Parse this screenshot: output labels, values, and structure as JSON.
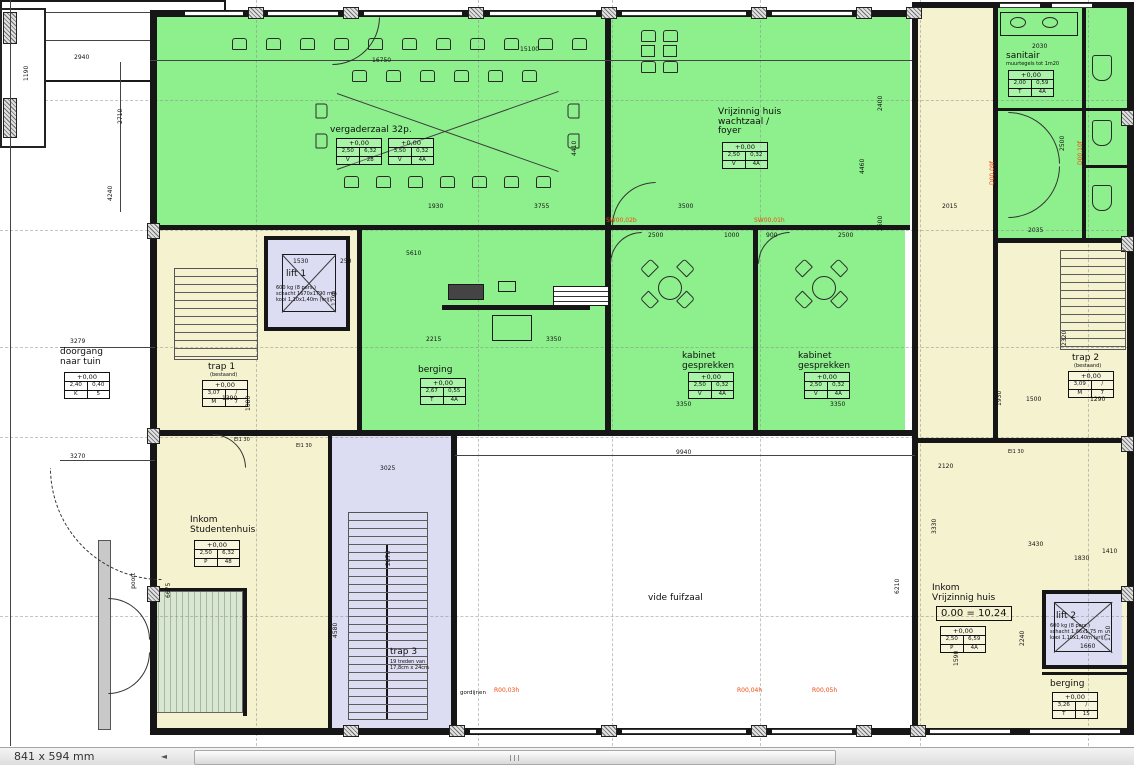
{
  "statusbar": {
    "size": "841 x 594 mm",
    "arrow": "◄"
  },
  "rooms": {
    "vergaderzaal": {
      "l": "vergaderzaal 32p.",
      "tA": {
        "h": "+0,00",
        "a": "2,50",
        "b": "6,32",
        "c": "V",
        "d": "28"
      },
      "tB": {
        "h": "+0,00",
        "a": "3,50",
        "b": "0,32",
        "c": "V",
        "d": "4A"
      }
    },
    "foyer": {
      "l": "Vrijzinnig huis\nwachtzaal /\nfoyer",
      "t": {
        "h": "+0,00",
        "a": "2,50",
        "b": "0,32",
        "c": "V",
        "d": "4A"
      }
    },
    "sanitair": {
      "l": "sanitair",
      "s": "muurtegels tot 1m20",
      "t": {
        "h": "+0,00",
        "a": "2,00",
        "b": "0,59",
        "c": "T",
        "d": "4A"
      }
    },
    "kabinet1": {
      "l": "kabinet\ngesprekken",
      "t": {
        "h": "+0,00",
        "a": "2,50",
        "b": "0,32",
        "c": "V",
        "d": "4A"
      }
    },
    "kabinet2": {
      "l": "kabinet\ngesprekken",
      "t": {
        "h": "+0,00",
        "a": "2,50",
        "b": "0,32",
        "c": "V",
        "d": "4A"
      }
    },
    "berging": {
      "l": "berging",
      "t": {
        "h": "+0,00",
        "a": "2,67",
        "b": "0,55",
        "c": "T",
        "d": "4A"
      }
    },
    "trap1": {
      "l": "trap 1",
      "s": "(bestaand)",
      "t": {
        "h": "+0,00",
        "a": "3,07",
        "b": "/",
        "c": "M",
        "d": "7"
      }
    },
    "trap2": {
      "l": "trap 2",
      "s": "(bestaand)",
      "t": {
        "h": "+0,00",
        "a": "3,09",
        "b": "/",
        "c": "M",
        "d": "7"
      }
    },
    "trap3": {
      "l": "trap 3",
      "s": "19 treden van\n17,8cm x 24cm"
    },
    "lift1": {
      "l": "lift 1",
      "s": "600 kg (8 pers.)\nschacht 1670x1790 mm\nkooi 1,10x1,40m (vrij)"
    },
    "lift2": {
      "l": "lift 2",
      "s": "600 kg (8 pers.)\nschacht 1,66x1,75 m\nkooi 1,10x1,40m (vrij)"
    },
    "doorgang": {
      "l": "doorgang\nnaar tuin",
      "t": {
        "h": "+0,00",
        "a": "2,40",
        "b": "0,40",
        "c": "K",
        "d": "5"
      }
    },
    "inkomstud": {
      "l": "Inkom\nStudentenhuis",
      "t": {
        "h": "+0,00",
        "a": "2,50",
        "b": "6,32",
        "c": "P",
        "d": "48"
      }
    },
    "inkomvrij": {
      "l": "Inkom\nVrijzinnig huis",
      "lvl": "0.00 = 10.24",
      "t": {
        "h": "+0,00",
        "a": "2,50",
        "b": "6,59",
        "c": "P",
        "d": "4A"
      }
    },
    "vide": {
      "l": "vide fuifzaal"
    },
    "berging2": {
      "l": "berging",
      "t": {
        "h": "+0,00",
        "a": "3,26",
        "b": "/",
        "c": "T",
        "d": "15"
      }
    }
  },
  "labels": {
    "gordijnen": "gordijnen",
    "poort": "poort",
    "ei30": "EI1 30"
  },
  "doors": {
    "sw2": "SW00,02b",
    "sw1": "SW00,01h",
    "r3": "R00,03h",
    "r4": "R00,04h",
    "r5": "R00,05h",
    "d9": "D00,09f",
    "d10": "D00,10f"
  },
  "dims": {
    "2940": "2940",
    "16750": "16750",
    "15100": "15100",
    "1190": "1190",
    "2710": "2710",
    "4240": "4240",
    "6200": "6200",
    "8900": "8900",
    "3370": "3370",
    "2835": "2835",
    "3279": "3279",
    "3270": "3270",
    "4410": "4410",
    "2400": "2400",
    "4460": "4460",
    "2600": "2600",
    "1930a": "1930",
    "1930b": "1930",
    "3755": "3755",
    "3500": "3500",
    "2500a": "2500",
    "2500b": "2500",
    "2500c": "2500",
    "1000": "1000",
    "900": "900",
    "5610": "5610",
    "2215": "2215",
    "3350a": "3350",
    "3350b": "3350",
    "3350c": "3350",
    "1530": "1530",
    "250": "250",
    "1790": "1790",
    "1390": "1390",
    "1080": "1080",
    "9940": "9940",
    "3025": "3025",
    "2876": "2876",
    "4580": "4580",
    "6675": "6675",
    "6210": "6210",
    "2120": "2120",
    "3330": "3330",
    "3430": "3430",
    "1830": "1830",
    "1410": "1410",
    "1500": "1500",
    "1290": "1290",
    "2320": "2320",
    "2030": "2030",
    "2035": "2035",
    "2015": "2015",
    "1660": "1660",
    "1750": "1750",
    "2240": "2240",
    "1590": "1590"
  }
}
